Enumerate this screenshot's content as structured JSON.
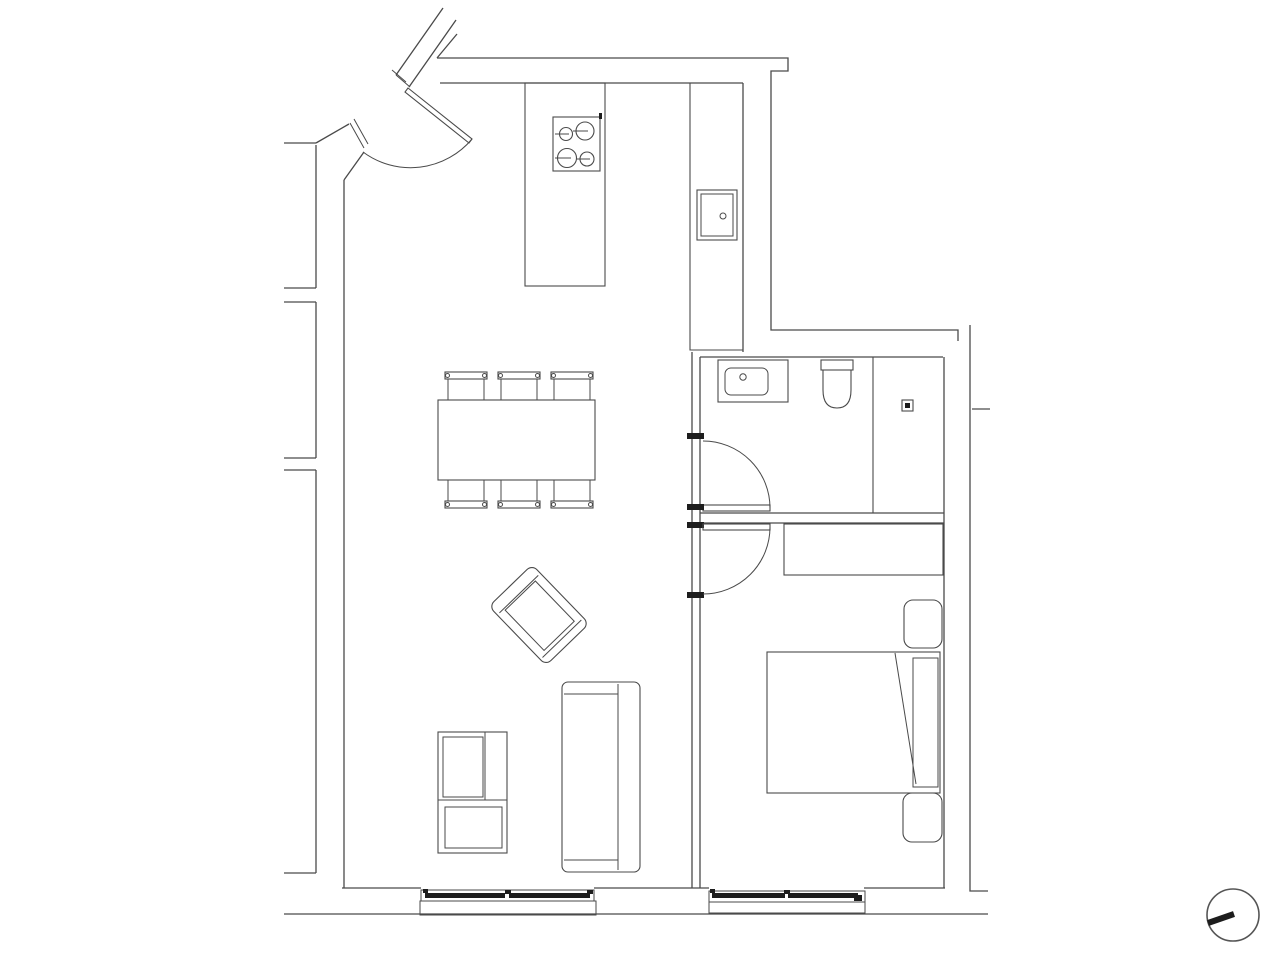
{
  "colors": {
    "background": "#ffffff",
    "line": "#4a4a4a",
    "dark": "#1d1d1d",
    "compass": "#555555"
  },
  "plan": {
    "type": "apartment floor plan, black-and-white line drawing, no text labels",
    "rooms": [
      "open-kitchen-living-dining-area",
      "bathroom",
      "bedroom"
    ],
    "fixtures_and_furniture": [
      "kitchen-island-with-4-burner-cooktop",
      "kitchen-counter-with-sink",
      "dining-table-with-6-chairs",
      "rotated-armchair",
      "sofa",
      "shelf-unit",
      "bathroom-vanity-sink",
      "toilet",
      "shower-with-floor-drain",
      "wardrobe",
      "double-bed-with-two-pillows-and-folded-duvet"
    ],
    "architectural_features": [
      "angled-entrance-door-with-swing-arc",
      "bathroom-door-with-swing-arc",
      "bedroom-door-with-swing-arc",
      "living-room-window",
      "bedroom-window",
      "party-wall-stubs-to-adjacent-unit",
      "north-compass-indicator"
    ],
    "counts": {
      "doors": 3,
      "windows": 2,
      "dining_chairs": 6,
      "cooktop_burners": 4
    }
  }
}
